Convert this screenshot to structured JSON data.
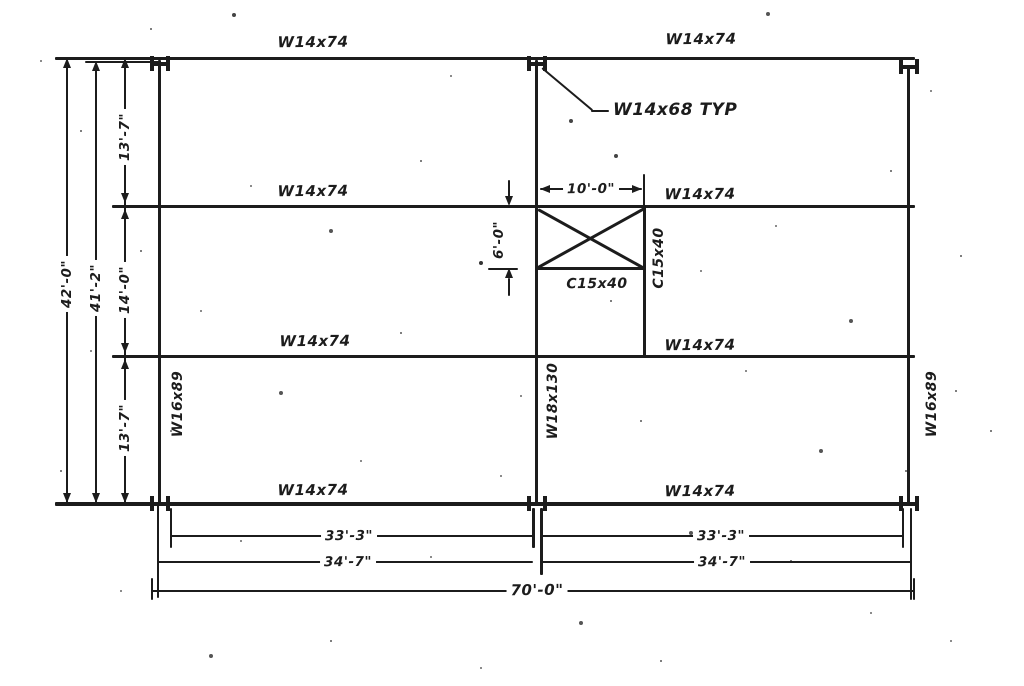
{
  "drawing": {
    "title": "steel-framing-plan",
    "beam_labels": {
      "top_left": "W14x74",
      "top_right": "W14x74",
      "mid_left": "W14x74",
      "mid_right": "W14x74",
      "lower_left": "W14x74",
      "lower_right": "W14x74",
      "bottom_left": "W14x74",
      "bottom_right": "W14x74"
    },
    "column_labels": {
      "left": "W16x89",
      "center": "W18x130",
      "right": "W16x89"
    },
    "callout_label": "W14x68 TYP",
    "channel_labels": {
      "bottom": "C15x40",
      "side": "C15x40"
    },
    "dimensions": {
      "overall_height": "42'-0\"",
      "inner_height": "41'-2\"",
      "upper_bay_height": "13'-7\"",
      "middle_bay_height": "14'-0\"",
      "lower_bay_height": "13'-7\"",
      "opening_width": "10'-0\"",
      "opening_height": "6'-0\"",
      "left_span_inner": "33'-3\"",
      "right_span_inner": "33'-3\"",
      "left_span_outer": "34'-7\"",
      "right_span_outer": "34'-7\"",
      "overall_width": "70'-0\""
    },
    "colors": {
      "ink": "#1c1c1c",
      "paper": "#ffffff"
    }
  }
}
